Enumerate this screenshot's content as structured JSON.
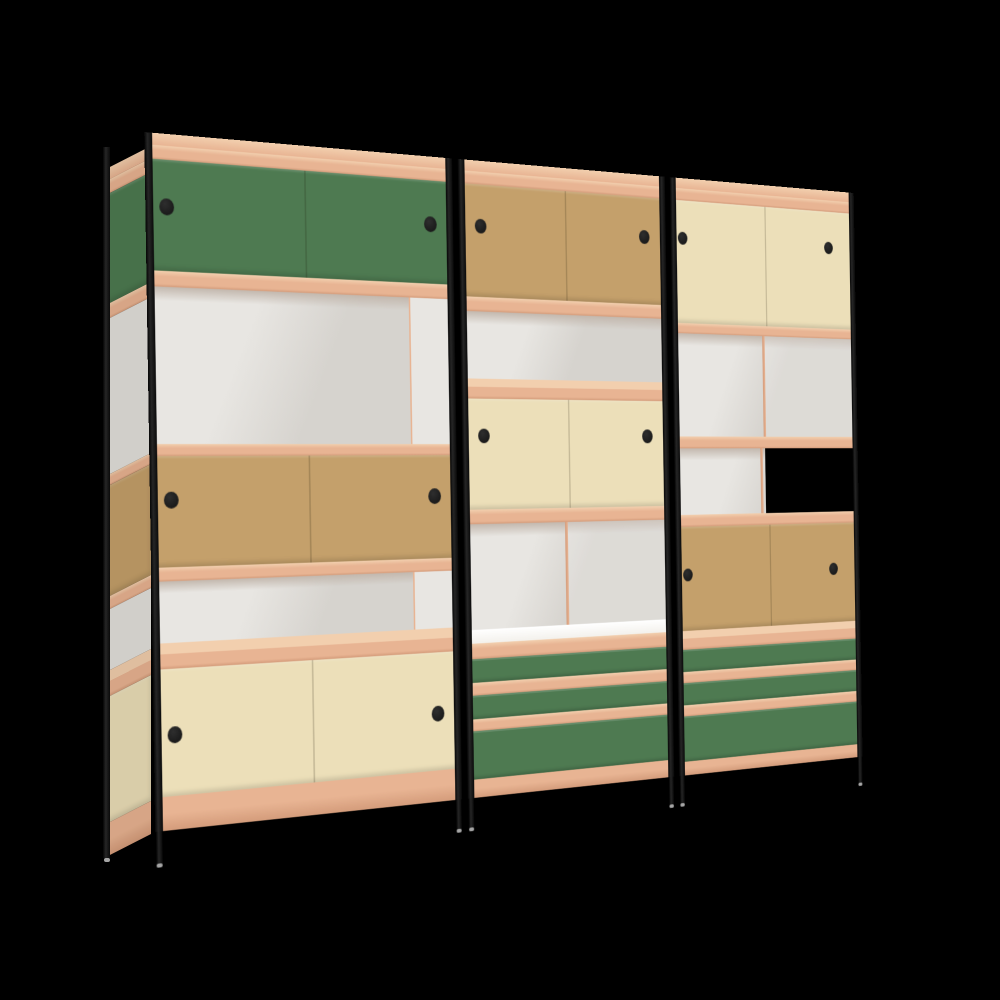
{
  "scene": {
    "background": "#000000",
    "description": "3D render of a three-bay modular shelving wall unit with black steel posts, plywood-edge shelves, sliding doors in green, kraft tan and cream, green drawers, on a black background"
  },
  "colors": {
    "background": "#000000",
    "frame_black": "#161616",
    "post_gradient_mid": "#262626",
    "green": "#4e7a51",
    "kraft_tan": "#c4a06b",
    "cream": "#ecdfb9",
    "ply_edge": "#e8b493",
    "ply_top": "#f2cfae",
    "ply_shadow": "#d49c7b",
    "interior_grey": "#d6d3ce",
    "interior_light": "#e8e6e2",
    "interior_ceiling": "#c3b8ae",
    "white_shelf_top": "#f3f1ec",
    "pull_black": "#1c1c1c",
    "glide_silver": "#a6a6a6",
    "open_back_void": "#000000"
  },
  "unit": {
    "x": 150,
    "y": 132,
    "flat_width": 1004,
    "flat_height": 740,
    "perspective": 2000,
    "rotate_y_deg": 28.8,
    "tilt_deg": -0.9,
    "frame": {
      "post_width": 9,
      "leg_top": 700,
      "leg_bottom": 732,
      "glide_height": 4
    },
    "side_panel": {
      "x": 104,
      "y": 146,
      "width": 47,
      "height": 688,
      "skew_deg": -27,
      "scale": 0.983
    },
    "side_post": {
      "x": 103,
      "y": 147,
      "width": 7,
      "height": 711,
      "glide_y": 858
    },
    "bays": [
      {
        "id": "left",
        "x": 0,
        "width": 383,
        "pull_x": [
          0.065,
          0.92
        ],
        "pull_diameter": 17,
        "rows": [
          {
            "t": "topface",
            "y": [
              0,
              12
            ]
          },
          {
            "t": "ply",
            "y": [
              12,
              26
            ]
          },
          {
            "t": "doors",
            "y": [
              26,
              138
            ],
            "c": "green",
            "pull_frac": 0.42
          },
          {
            "t": "ply",
            "y": [
              138,
              154
            ]
          },
          {
            "t": "open",
            "y": [
              154,
              312
            ],
            "variant": "sidewall"
          },
          {
            "t": "ply",
            "y": [
              312,
              324
            ]
          },
          {
            "t": "doors",
            "y": [
              324,
              436
            ],
            "c": "kraft_tan",
            "pull_frac": 0.4
          },
          {
            "t": "ply",
            "y": [
              436,
              450
            ]
          },
          {
            "t": "open",
            "y": [
              450,
              512
            ],
            "variant": "sidewall"
          },
          {
            "t": "shelf",
            "y": [
              512,
              538
            ]
          },
          {
            "t": "doors",
            "y": [
              538,
              666
            ],
            "c": "cream",
            "pull_frac": 0.52
          },
          {
            "t": "base",
            "y": [
              666,
              700
            ]
          }
        ]
      },
      {
        "id": "middle",
        "x": 391,
        "width": 301,
        "pull_x": [
          0.1,
          0.89
        ],
        "pull_diameter": 16,
        "rows": [
          {
            "t": "topface",
            "y": [
              0,
              12
            ]
          },
          {
            "t": "ply",
            "y": [
              12,
              26
            ]
          },
          {
            "t": "doors",
            "y": [
              26,
              150
            ],
            "c": "kraft_tan",
            "pull_frac": 0.37
          },
          {
            "t": "ply",
            "y": [
              150,
              166
            ]
          },
          {
            "t": "open",
            "y": [
              166,
              240
            ],
            "variant": "plain"
          },
          {
            "t": "shelf",
            "y": [
              240,
              262
            ]
          },
          {
            "t": "doors",
            "y": [
              262,
              384
            ],
            "c": "cream",
            "pull_frac": 0.34
          },
          {
            "t": "ply",
            "y": [
              384,
              400
            ]
          },
          {
            "t": "open",
            "y": [
              400,
              516
            ],
            "variant": "divided-light"
          },
          {
            "t": "whitetop",
            "y": [
              516,
              531
            ]
          },
          {
            "t": "ply",
            "y": [
              531,
              548
            ]
          },
          {
            "t": "drawer",
            "y": [
              548,
              574
            ],
            "c": "green"
          },
          {
            "t": "ply",
            "y": [
              574,
              588
            ]
          },
          {
            "t": "drawer",
            "y": [
              588,
              614
            ],
            "c": "green"
          },
          {
            "t": "ply",
            "y": [
              614,
              627
            ]
          },
          {
            "t": "drawer",
            "y": [
              627,
              680
            ],
            "c": "green"
          },
          {
            "t": "base",
            "y": [
              680,
              700
            ]
          }
        ]
      },
      {
        "id": "right",
        "x": 700,
        "width": 304,
        "pull_x": [
          0.06,
          0.85
        ],
        "pull_diameter": 15,
        "rows": [
          {
            "t": "topface",
            "y": [
              0,
              12
            ]
          },
          {
            "t": "ply",
            "y": [
              12,
              26
            ]
          },
          {
            "t": "doors",
            "y": [
              26,
              170
            ],
            "c": "cream",
            "pull_frac": 0.31
          },
          {
            "t": "ply",
            "y": [
              170,
              182
            ]
          },
          {
            "t": "open",
            "y": [
              182,
              303
            ],
            "variant": "divided"
          },
          {
            "t": "ply",
            "y": [
              303,
              317
            ]
          },
          {
            "t": "open",
            "y": [
              317,
              395
            ],
            "variant": "half-void"
          },
          {
            "t": "ply",
            "y": [
              395,
              409
            ]
          },
          {
            "t": "doors",
            "y": [
              409,
              531
            ],
            "c": "kraft_tan",
            "pull_frac": 0.46
          },
          {
            "t": "shelf",
            "y": [
              531,
              553
            ]
          },
          {
            "t": "drawer",
            "y": [
              553,
              579
            ],
            "c": "green"
          },
          {
            "t": "ply",
            "y": [
              579,
              592
            ]
          },
          {
            "t": "drawer",
            "y": [
              592,
              618
            ],
            "c": "green"
          },
          {
            "t": "ply",
            "y": [
              618,
              631
            ]
          },
          {
            "t": "drawer",
            "y": [
              631,
              684
            ],
            "c": "green"
          },
          {
            "t": "base",
            "y": [
              684,
              700
            ]
          }
        ]
      }
    ]
  }
}
